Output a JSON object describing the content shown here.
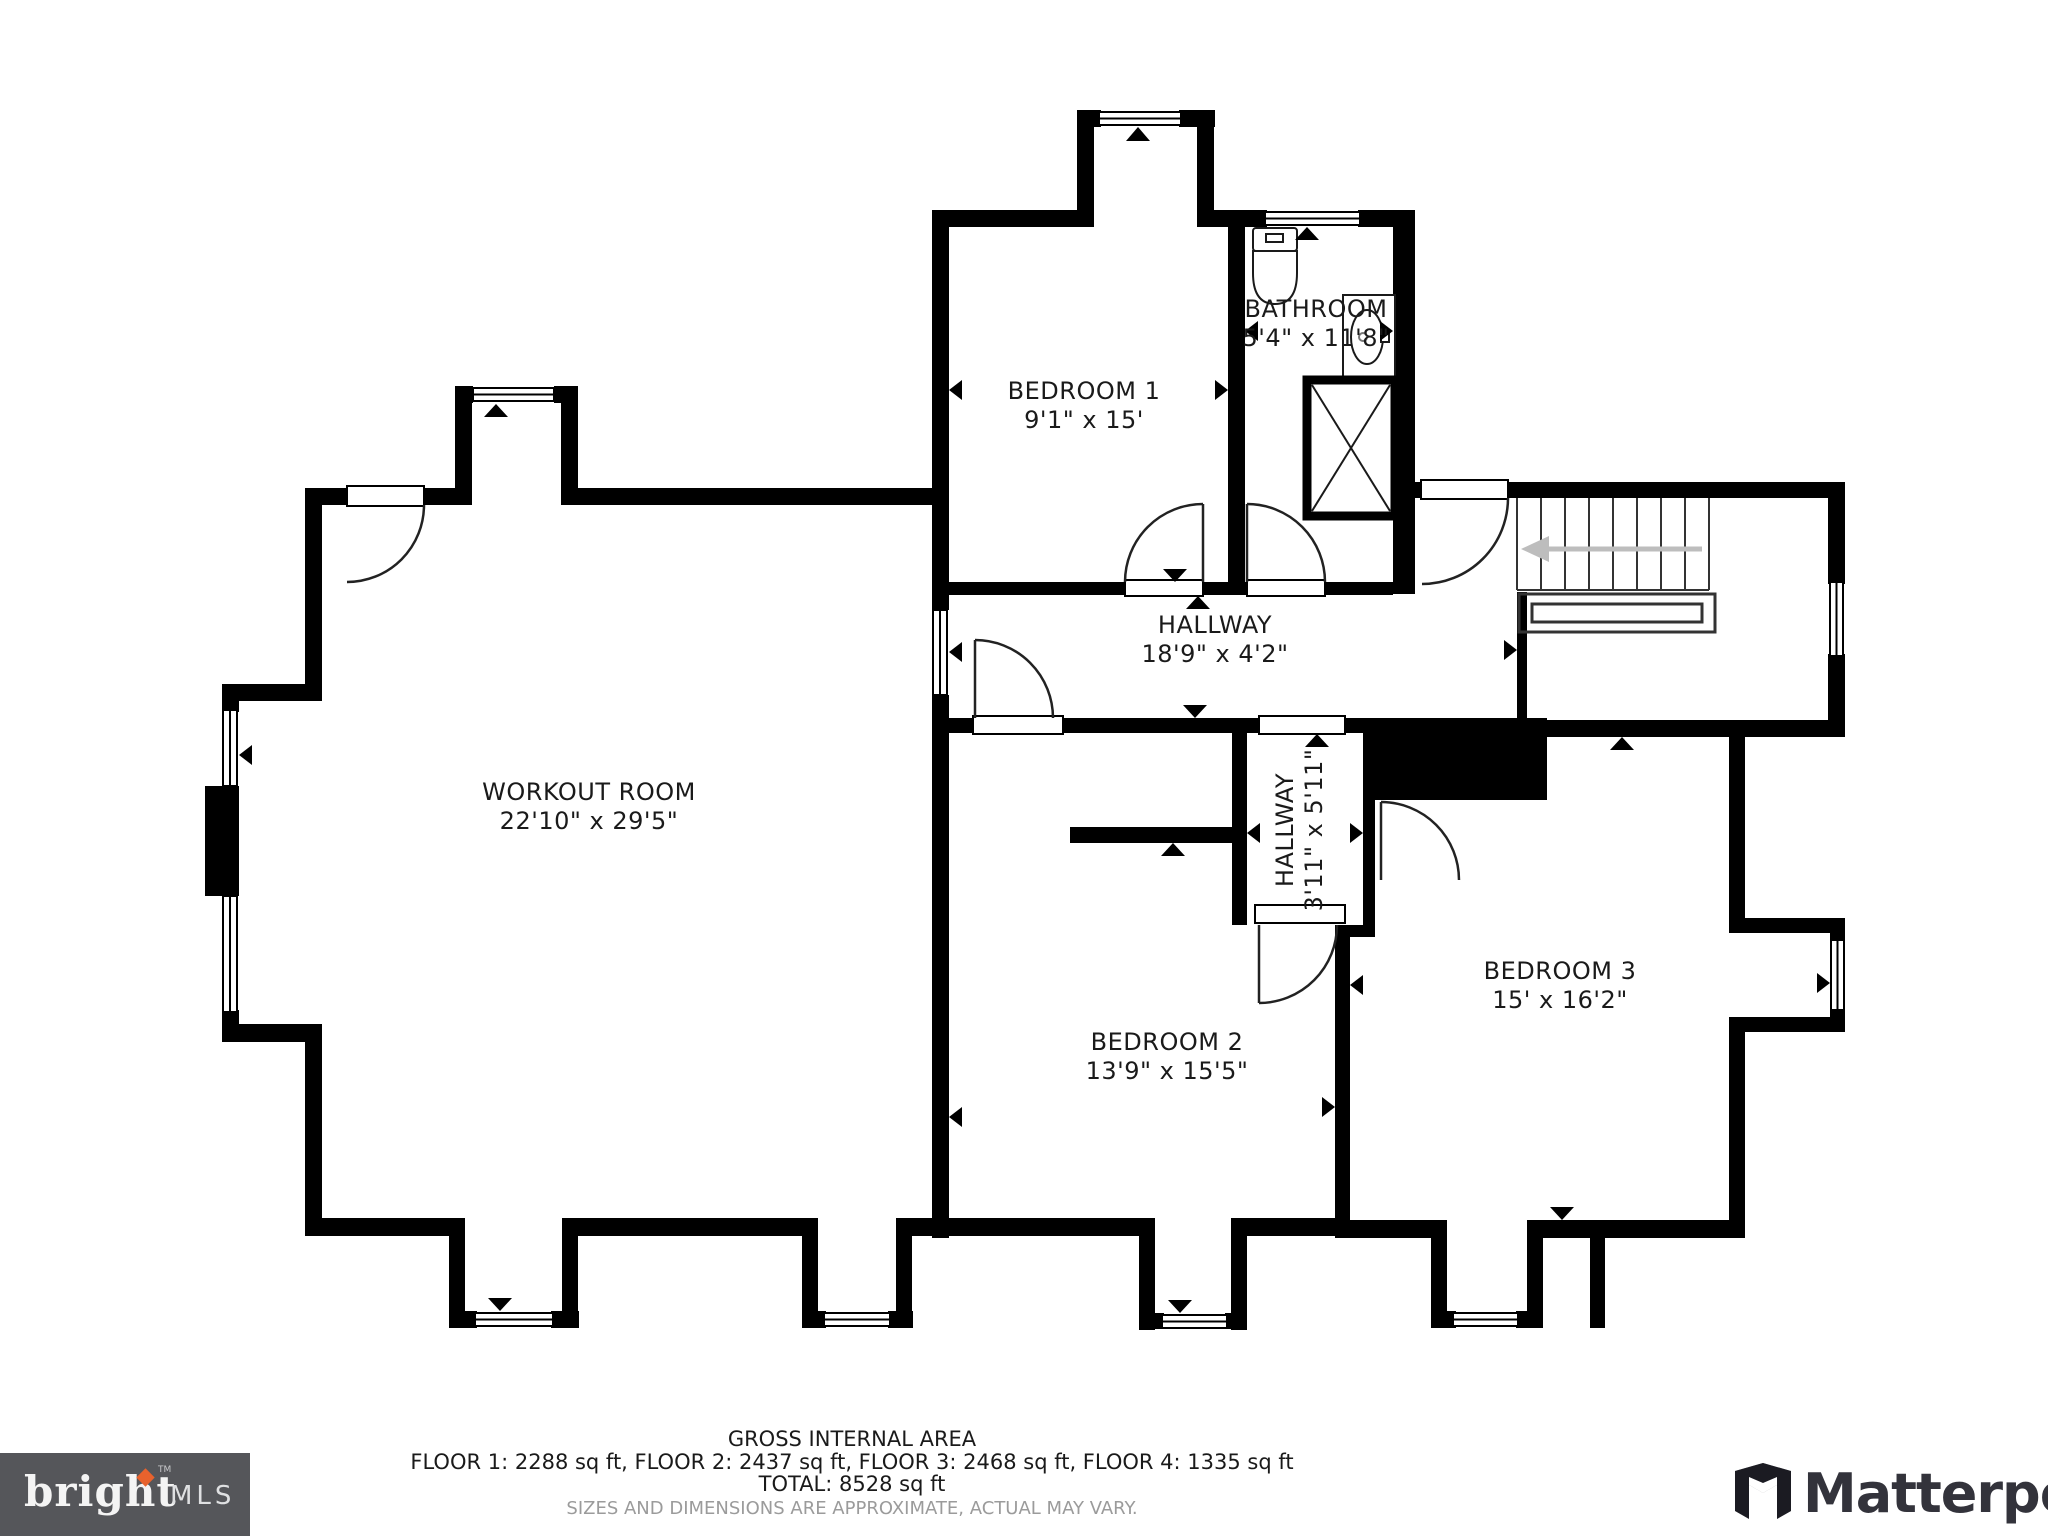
{
  "plan": {
    "rooms": [
      {
        "id": "workout-room",
        "name": "WORKOUT ROOM",
        "dims": "22'10\" x 29'5\""
      },
      {
        "id": "bedroom-1",
        "name": "BEDROOM 1",
        "dims": "9'1\" x 15'"
      },
      {
        "id": "bathroom",
        "name": "BATHROOM",
        "dims": "5'4\" x 11'8\""
      },
      {
        "id": "hallway",
        "name": "HALLWAY",
        "dims": "18'9\" x 4'2\""
      },
      {
        "id": "hallway-2",
        "name": "HALLWAY",
        "dims": "3'11\" x 5'11\""
      },
      {
        "id": "bedroom-2",
        "name": "BEDROOM 2",
        "dims": "13'9\" x 15'5\""
      },
      {
        "id": "bedroom-3",
        "name": "BEDROOM 3",
        "dims": "15' x 16'2\""
      }
    ]
  },
  "footer": {
    "title": "GROSS INTERNAL AREA",
    "floors": "FLOOR 1: 2288 sq ft, FLOOR 2: 2437 sq ft, FLOOR 3: 2468 sq ft, FLOOR 4: 1335 sq ft",
    "total": "TOTAL: 8528 sq ft",
    "disclaimer": "SIZES AND DIMENSIONS ARE APPROXIMATE, ACTUAL MAY VARY."
  },
  "logos": {
    "bright": {
      "name": "bright",
      "suffix": "MLS",
      "tm": "TM"
    },
    "matterport": {
      "name": "Matterport"
    }
  },
  "colors": {
    "wall": "#000000",
    "accent_orange": "#e8622d",
    "bright_bg": "#55565a",
    "stair_arrow": "#bdbdbd"
  }
}
